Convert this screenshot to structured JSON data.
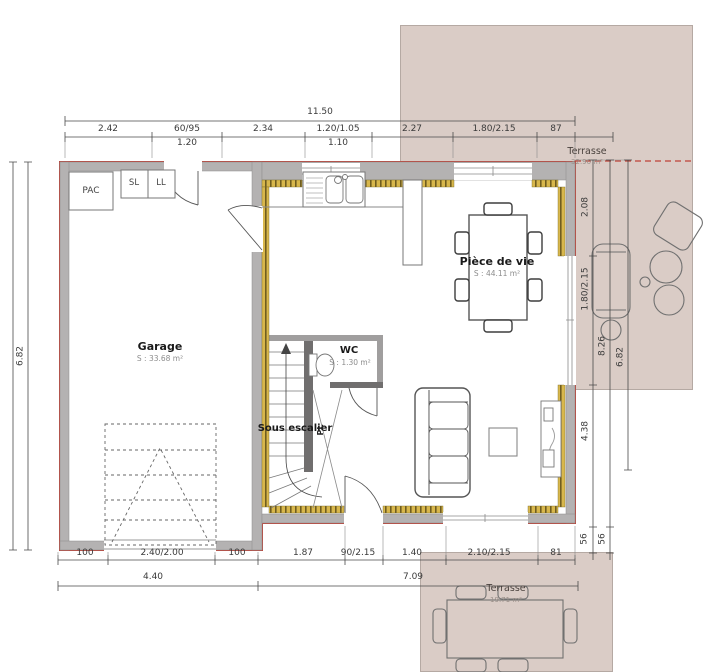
{
  "document": {
    "type": "floor-plan",
    "colors": {
      "terrace_fill": "#daccc6",
      "exterior_line_red": "#bf4136",
      "wall_gray": "#b4b2b2",
      "insulation_gold": "#d8b74c"
    }
  },
  "dimensions": {
    "overall_width": "11.50",
    "top": [
      "2.42",
      "60/95",
      "2.34",
      "1.20/1.05",
      "2.27",
      "1.80/2.15",
      "87"
    ],
    "top_sub": [
      "1.20",
      "1.10"
    ],
    "left": "6.82",
    "right": [
      "2.08",
      "1.80/2.15",
      "8.26",
      "6.82",
      "4.38",
      "56",
      "56"
    ],
    "bottom": [
      "100",
      "2.40/2.00",
      "100",
      "1.87",
      "90/2.15",
      "1.40",
      "2.10/2.15",
      "81"
    ],
    "bottom2": [
      "4.40",
      "7.09"
    ]
  },
  "rooms": {
    "pac": "PAC",
    "sl": "SL",
    "ll": "LL",
    "garage": {
      "name": "Garage",
      "area": "S : 33.68 m²"
    },
    "living": {
      "name": "Pièce de vie",
      "area": "S : 44.11 m²"
    },
    "wc": {
      "name": "WC",
      "area": "S : 1.30 m²"
    },
    "under_stairs": {
      "name": "Sous escalier",
      "closet": "PL"
    },
    "terrace_right": {
      "name": "Terrasse",
      "area": "32.90 m²"
    },
    "terrace_bottom": {
      "name": "Terrasse",
      "area": "19.71 m²"
    }
  }
}
